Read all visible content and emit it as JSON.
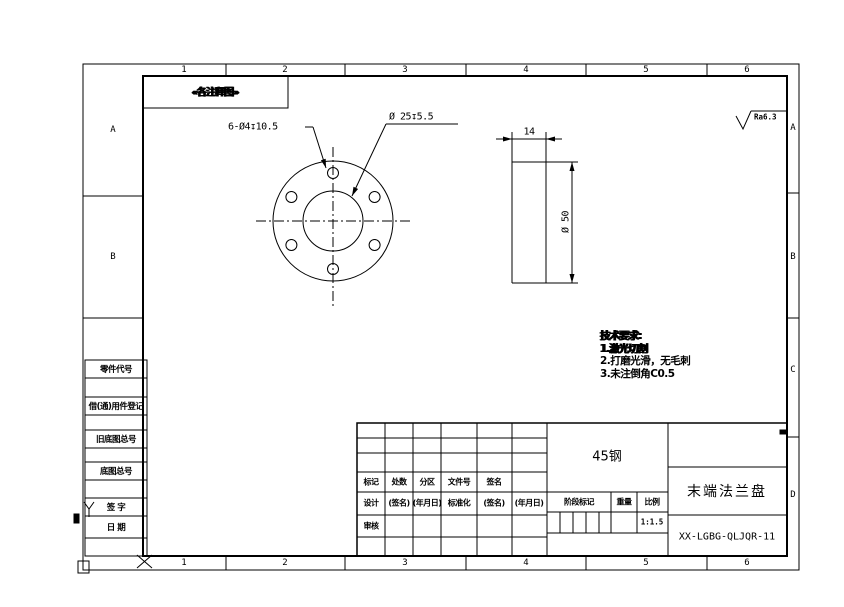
{
  "grid": {
    "top_numbers": [
      "1",
      "2",
      "3",
      "4",
      "5",
      "6"
    ],
    "bottom_numbers": [
      "1",
      "2",
      "3",
      "4",
      "5",
      "6"
    ],
    "left_letters": [
      "A",
      "B"
    ],
    "right_letters": [
      "A",
      "B",
      "C",
      "D"
    ]
  },
  "annotation_box": {
    "text": "«各注释图»"
  },
  "front_view": {
    "holes_label": "6-Ø4↧10.5",
    "bore_label": "Ø 25↧5.5"
  },
  "side_view": {
    "width_label": "14",
    "diameter_label": "Ø 50"
  },
  "surface_finish": {
    "label": "Ra6.3"
  },
  "tech_requirements": {
    "title": "技术要求:",
    "items": [
      "1.激光切割",
      "2.打磨光滑，无毛刺",
      "3.未注倒角C0.5"
    ]
  },
  "side_blocks": {
    "labels": [
      "零件代号",
      "借(通)用件登记",
      "旧底图总号",
      "底图总号",
      "签  字",
      "日  期"
    ]
  },
  "title_block": {
    "record_header": [
      "标记",
      "处数",
      "分区",
      "文件号",
      "签名"
    ],
    "sign_row": [
      "设计",
      "(签名)",
      "(年月日)",
      "标准化",
      "(签名)",
      "(年月日)"
    ],
    "audit_label": "审核",
    "material": "45钢",
    "stage_label": "阶段标记",
    "weight_label": "重量",
    "scale_label": "比例",
    "scale_value": "1:1.5",
    "part_name": "末端法兰盘",
    "drawing_number": "XX-LGBG-QLJQR-11"
  },
  "colors": {
    "line": "#000000",
    "paper": "#ffffff"
  }
}
